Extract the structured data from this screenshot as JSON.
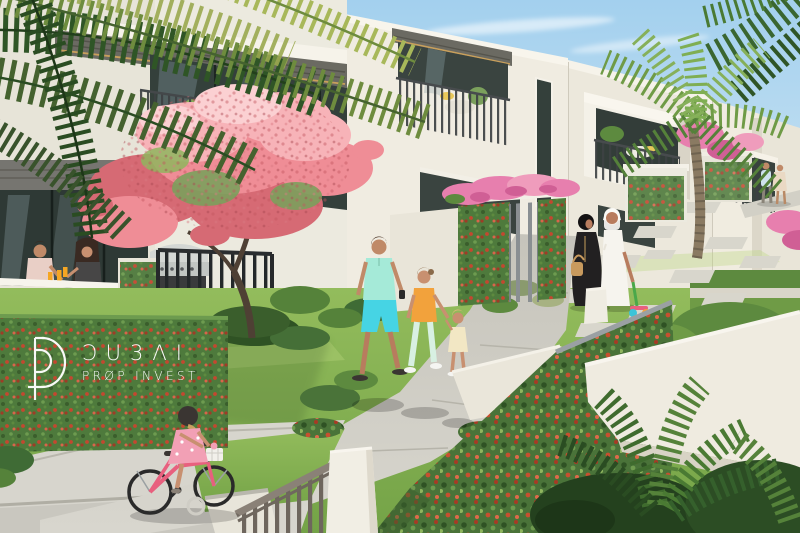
{
  "watermark": {
    "monogram_icon": "dp-monogram",
    "wordmark": "ƆU3ΛI",
    "tagline": "PRØP INVEST"
  },
  "palette": {
    "sky_top": "#a3d0ee",
    "sky_bottom": "#d8eaf5",
    "cloud_white": "#ffffff",
    "building_sunlit": "#f0ece1",
    "building_shaded": "#d9d4c7",
    "soffit_grey": "#6b6a62",
    "fascia_wood": "#c9a05c",
    "glass_dark": "#34403b",
    "glass_reflection": "#9fb3ba",
    "railing_grey": "#3d4143",
    "grass_light": "#93bc5c",
    "grass_dark": "#74a347",
    "foliage_dark": "#2f5526",
    "foliage_mid": "#4a7a33",
    "foliage_light": "#86b05a",
    "palm_yellow_green": "#a8b85a",
    "vine_green": "#4e7a3c",
    "vine_flower_red": "#c4472f",
    "hedge_flower_red": "#c8502f",
    "blossom_pink": "#ef8d96",
    "blossom_pink_light": "#f7b3b8",
    "bougainvillea_pink": "#e77fae",
    "path_concrete": "#cfcdc5",
    "pavement_grey": "#d5d3cb",
    "stepping_stone": "#d8d6cc",
    "wall_white": "#efebe0",
    "gate_black": "#24282a",
    "fence_taupe": "#8a8177",
    "trunk_brown": "#4e4034",
    "palm_trunk": "#8a7a62",
    "skin_tan": "#c08a68",
    "kandura_white": "#f6f4ee",
    "abaya_black": "#222021",
    "handbag_tan": "#c89a5e",
    "polo_mint": "#a5ead8",
    "shorts_turquoise": "#46d4e4",
    "tshirt_orange": "#f2a23c",
    "pants_mint": "#d8f0e2",
    "child_outfit_cream": "#f2e7c4",
    "dress_pink": "#f2a0b5",
    "bike_pink": "#e8607e",
    "helmet_black": "#3a3532",
    "juice_orange": "#f5a623",
    "logo_white": "#ffffff"
  }
}
